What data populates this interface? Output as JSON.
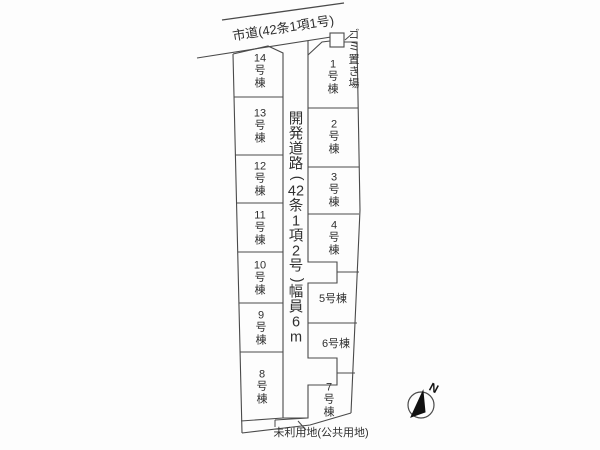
{
  "colors": {
    "line": "#4a4a4a",
    "text": "#2f2f2f",
    "bg": "#fdfdfd",
    "compass_fill": "#111111"
  },
  "labels": {
    "city_road": "市道(42条1項1号)",
    "dev_road": "開発道路(42条1項2号)幅員6m",
    "garbage": "ゴミ置き場",
    "unused_land": "未利用地(公共用地)",
    "compass_n": "N"
  },
  "left_lots": [
    {
      "id": "14",
      "label": "14号棟"
    },
    {
      "id": "13",
      "label": "13号棟"
    },
    {
      "id": "12",
      "label": "12号棟"
    },
    {
      "id": "11",
      "label": "11号棟"
    },
    {
      "id": "10",
      "label": "10号棟"
    },
    {
      "id": "9",
      "label": "9号棟"
    },
    {
      "id": "8",
      "label": "8号棟"
    }
  ],
  "right_lots": [
    {
      "id": "1",
      "label": "1号棟"
    },
    {
      "id": "2",
      "label": "2号棟"
    },
    {
      "id": "3",
      "label": "3号棟"
    },
    {
      "id": "4",
      "label": "4号棟"
    },
    {
      "id": "5",
      "label": "5号棟"
    },
    {
      "id": "6",
      "label": "6号棟"
    },
    {
      "id": "7",
      "label": "7号棟"
    }
  ],
  "road": {
    "width_note": "幅員6m"
  }
}
